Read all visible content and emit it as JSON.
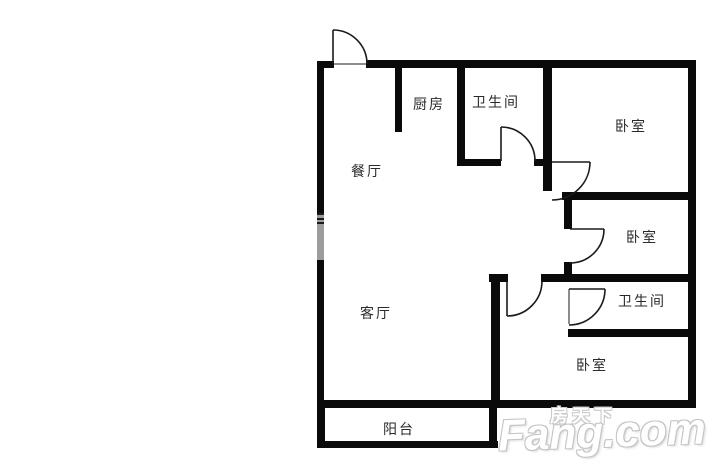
{
  "floorplan": {
    "rooms": {
      "kitchen": {
        "label": "厨房"
      },
      "bathroom1": {
        "label": "卫生间"
      },
      "bedroom1": {
        "label": "卧室"
      },
      "dining": {
        "label": "餐厅"
      },
      "bedroom2": {
        "label": "卧室"
      },
      "bathroom2": {
        "label": "卫生间"
      },
      "living": {
        "label": "客厅"
      },
      "bedroom3": {
        "label": "卧室"
      },
      "balcony": {
        "label": "阳台"
      }
    },
    "colors": {
      "wall": "#0a0a0a",
      "window": "#9c9c9c",
      "label_text": "#2a2a2a",
      "background": "#ffffff",
      "watermark_fill": "#ffffff",
      "watermark_outline": "#c4c4c4"
    }
  },
  "watermark": {
    "cn": "房天下",
    "en": "Fang.com"
  }
}
